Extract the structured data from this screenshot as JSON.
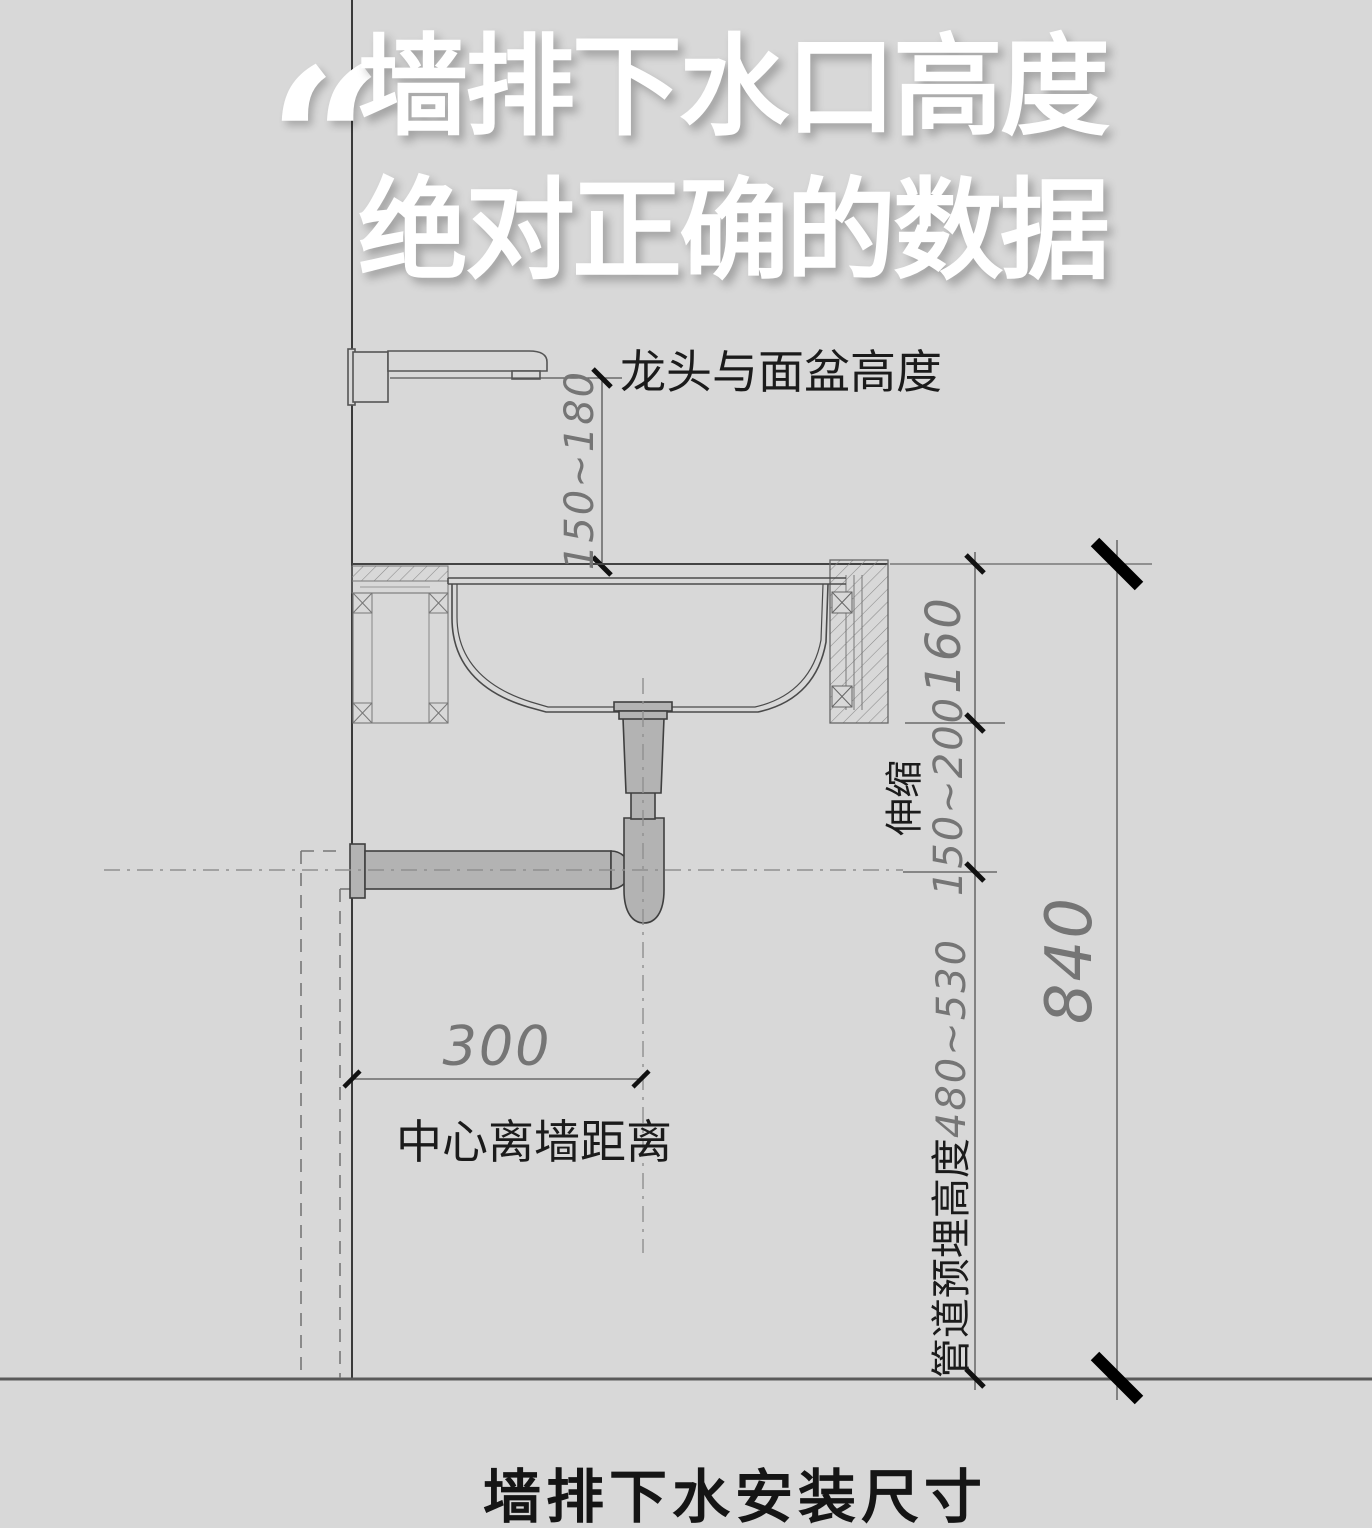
{
  "page": {
    "background_color": "#d8d8d8",
    "quote_mark": "“"
  },
  "title": {
    "line1": "墙排下水口高度",
    "line2": "绝对正确的数据",
    "color": "#ffffff"
  },
  "caption": "墙排下水安装尺寸",
  "diagram": {
    "labels": {
      "faucet_basin_height": "龙头与面盆高度",
      "telescopic": "伸缩",
      "center_wall_distance": "中心离墙距离",
      "pipe_embed_label": "管道预埋高度"
    },
    "dimensions": {
      "faucet_to_basin": "150~180",
      "counter_to_trap_top": "160",
      "trap_telescopic_range": "150~200",
      "total_height": "840",
      "pipe_embed_height": "480~530",
      "center_offset": "300"
    },
    "colors": {
      "line": "#4a4a4a",
      "dim_text": "#757575",
      "pipe_fill": "#b3b3b3",
      "pipe_outline": "#3f3f3f",
      "tick": "#000000"
    }
  }
}
